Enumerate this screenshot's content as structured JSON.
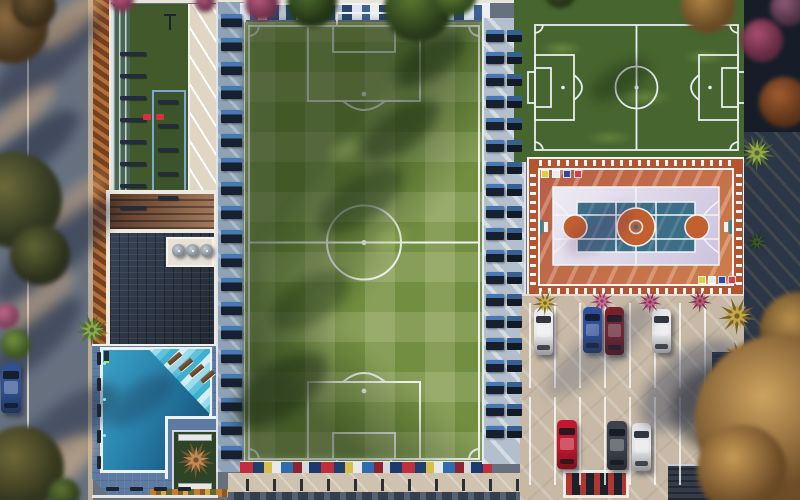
{
  "scene": {
    "description": "Aerial drone view render of a sports club complex: main soccer field, mini soccer field, multipurpose basketball and volleyball court, L-shaped swimming pool with clubhouse, outdoor gym strip, and parking lot with cars, surrounded by streets, palms and trees",
    "width": 800,
    "height": 500
  },
  "palette": {
    "street": "#66707f",
    "street_curb": "#b9ac98",
    "mulch": "#8a4e28",
    "turf_dark": "#42592c",
    "walkway_cream": "#e9e0cf",
    "roof_dark": "#2b3441",
    "roof_sun": "#7c513b",
    "trim_white": "#f1ede4",
    "deck_blue": "#5d7aa2",
    "water_light": "#3aa2c6",
    "water_deep": "#174f72",
    "steps_blue": "#9adceb",
    "grass_base": "#728e40",
    "field_line": "#eef2f4",
    "bench_navy": "#17202e",
    "bench_blue": "#4879b4",
    "strip_blue": "#8fa3b8",
    "stand_navy": "#2e4460",
    "court_ring_red": "#b5552f",
    "court_terracotta": "#c16a3a",
    "court_lavender": "#dcd7e8",
    "court_blue": "#3d6e88",
    "court_orange": "#c2602f",
    "parking_concrete": "#c7b9a5",
    "tree_gold": "#cda35f"
  },
  "strips": {
    "stand_main": {
      "angle": 90,
      "segments": [
        {
          "c": "#dfe7ee",
          "w": 10
        },
        {
          "c": "#3c6296",
          "w": 8
        },
        {
          "c": "#eceff3",
          "w": 9
        },
        {
          "c": "#27456e",
          "w": 12
        },
        {
          "c": "#b8c6d4",
          "w": 7
        },
        {
          "c": "#27456e",
          "w": 10
        }
      ]
    },
    "stand_mini": {
      "angle": 90,
      "segments": [
        {
          "c": "#d8e0e8",
          "w": 8
        },
        {
          "c": "#2e4f86",
          "w": 9
        },
        {
          "c": "#c44250",
          "w": 5
        },
        {
          "c": "#2e4f86",
          "w": 8
        },
        {
          "c": "#e8ebef",
          "w": 8
        },
        {
          "c": "#223c64",
          "w": 10
        }
      ]
    },
    "seats_south": {
      "angle": 90,
      "segments": [
        {
          "c": "#c22e3e",
          "w": 13
        },
        {
          "c": "#203e6e",
          "w": 11
        },
        {
          "c": "#d6c048",
          "w": 8
        },
        {
          "c": "#e9e9ec",
          "w": 9
        },
        {
          "c": "#2e6cb0",
          "w": 12
        },
        {
          "c": "#8c2432",
          "w": 9
        },
        {
          "c": "#d8d8da",
          "w": 7
        },
        {
          "c": "#1d3a6e",
          "w": 12
        }
      ]
    },
    "hedge_south": {
      "angle": 90,
      "segments": [
        {
          "c": "#c87c30",
          "w": 6
        },
        {
          "c": "#8a5a28",
          "w": 5
        },
        {
          "c": "#d8a848",
          "w": 5
        },
        {
          "c": "#5c6a30",
          "w": 6
        }
      ]
    }
  },
  "court": {
    "corner_colors": [
      "#e5cb3e",
      "#efece6",
      "#2e4a9e",
      "#d63c4a"
    ],
    "top_left": {
      "x": 541,
      "y": 170,
      "step": 11,
      "size": 8
    },
    "bottom_right": {
      "x": 698,
      "y": 276,
      "step": 10,
      "size": 8
    }
  },
  "cars": [
    {
      "name": "street-car-white",
      "x": 8,
      "y": 206,
      "w": 17,
      "h": 34,
      "color": "#e8e8ea"
    },
    {
      "name": "street-car-blue",
      "x": 1,
      "y": 363,
      "w": 20,
      "h": 50,
      "color": "#31508f"
    },
    {
      "name": "parked-white-1",
      "x": 534,
      "y": 308,
      "w": 19,
      "h": 47,
      "color": "#ececee"
    },
    {
      "name": "parked-blue",
      "x": 583,
      "y": 307,
      "w": 19,
      "h": 46,
      "color": "#2e4f9e"
    },
    {
      "name": "parked-dark-red",
      "x": 605,
      "y": 307,
      "w": 19,
      "h": 48,
      "color": "#7e1c28"
    },
    {
      "name": "parked-white-2",
      "x": 652,
      "y": 309,
      "w": 19,
      "h": 44,
      "color": "#e9e9ec"
    },
    {
      "name": "parked-red",
      "x": 557,
      "y": 420,
      "w": 20,
      "h": 49,
      "color": "#c0182e"
    },
    {
      "name": "parked-gray",
      "x": 607,
      "y": 421,
      "w": 20,
      "h": 49,
      "color": "#3c424c"
    },
    {
      "name": "parked-white-3",
      "x": 632,
      "y": 423,
      "w": 19,
      "h": 48,
      "color": "#e6e7e9"
    }
  ],
  "trees": [
    {
      "x": 12,
      "y": 28,
      "r": 36,
      "c1": "#8a6a40",
      "c2": "#46351e"
    },
    {
      "x": 34,
      "y": 6,
      "r": 22,
      "c1": "#6a5432",
      "c2": "#3a2d18"
    },
    {
      "x": 14,
      "y": 200,
      "r": 48,
      "c1": "#6a6a3a",
      "c2": "#2f3520"
    },
    {
      "x": 40,
      "y": 255,
      "r": 30,
      "c1": "#5f6434",
      "c2": "#2b301c"
    },
    {
      "x": 6,
      "y": 316,
      "r": 13,
      "c1": "#c06a8c",
      "c2": "#7c3e58"
    },
    {
      "x": 16,
      "y": 344,
      "r": 15,
      "c1": "#74923e",
      "c2": "#3c5424"
    },
    {
      "x": 22,
      "y": 468,
      "r": 42,
      "c1": "#6e6838",
      "c2": "#33361e"
    },
    {
      "x": 64,
      "y": 494,
      "r": 16,
      "c1": "#5f7632",
      "c2": "#2e401c"
    },
    {
      "x": 122,
      "y": 0,
      "r": 12,
      "c1": "#c05a80",
      "c2": "#7a3450"
    },
    {
      "x": 205,
      "y": 2,
      "r": 10,
      "c1": "#b05878",
      "c2": "#6e3048"
    },
    {
      "x": 262,
      "y": 4,
      "r": 17,
      "c1": "#b55a7c",
      "c2": "#6e3048"
    },
    {
      "x": 312,
      "y": 2,
      "r": 25,
      "c1": "#4e6c2e",
      "c2": "#223414"
    },
    {
      "x": 418,
      "y": 8,
      "r": 34,
      "c1": "#5a782f",
      "c2": "#27391a"
    },
    {
      "x": 455,
      "y": -6,
      "r": 22,
      "c1": "#74903c",
      "c2": "#324a1e"
    },
    {
      "x": 560,
      "y": -8,
      "r": 16,
      "c1": "#4a682c",
      "c2": "#223014"
    },
    {
      "x": 708,
      "y": 6,
      "r": 27,
      "c1": "#b08446",
      "c2": "#684a24"
    },
    {
      "x": 762,
      "y": 40,
      "r": 21,
      "c1": "#a84e6e",
      "c2": "#642a42"
    },
    {
      "x": 788,
      "y": 8,
      "r": 18,
      "c1": "#8c5a78",
      "c2": "#4e3044"
    },
    {
      "x": 784,
      "y": 102,
      "r": 25,
      "c1": "#a05c30",
      "c2": "#5c3318"
    },
    {
      "x": 798,
      "y": 330,
      "r": 38,
      "c1": "#b8904e",
      "c2": "#604322"
    },
    {
      "x": 780,
      "y": 420,
      "r": 85,
      "c1": "#cda35f",
      "c2": "#6e4d28"
    },
    {
      "x": 742,
      "y": 470,
      "r": 45,
      "c1": "#c79a55",
      "c2": "#6a4926"
    }
  ],
  "palms": [
    {
      "name": "palm-pool-west",
      "x": 92,
      "y": 330,
      "r": 17,
      "c1": "#8aa84c",
      "c2": "#50702c"
    },
    {
      "name": "palm-planter",
      "x": 196,
      "y": 460,
      "r": 19,
      "c1": "#c08a52",
      "c2": "#7c5630"
    },
    {
      "name": "palm-yellow",
      "x": 545,
      "y": 303,
      "r": 13,
      "c1": "#c8b050",
      "c2": "#7c6c2e"
    },
    {
      "name": "palm-pink-1",
      "x": 602,
      "y": 301,
      "r": 12,
      "c1": "#cf6d95",
      "c2": "#8c3f60"
    },
    {
      "name": "palm-pink-2",
      "x": 650,
      "y": 302,
      "r": 12,
      "c1": "#c86088",
      "c2": "#83395a"
    },
    {
      "name": "palm-pink-3",
      "x": 700,
      "y": 301,
      "r": 12,
      "c1": "#c05878",
      "c2": "#7a3450"
    },
    {
      "name": "palm-gold-big",
      "x": 737,
      "y": 316,
      "r": 19,
      "c1": "#c6a748",
      "c2": "#776428"
    },
    {
      "name": "palm-orange",
      "x": 739,
      "y": 356,
      "r": 15,
      "c1": "#c07a42",
      "c2": "#7a4a26"
    },
    {
      "name": "palm-east-green",
      "x": 757,
      "y": 153,
      "r": 19,
      "c1": "#94aa4a",
      "c2": "#52682a"
    },
    {
      "name": "palm-east-dark",
      "x": 757,
      "y": 242,
      "r": 11,
      "c1": "#3e5a2c",
      "c2": "#243818"
    }
  ],
  "shadows": [
    {
      "layer": "ground",
      "x": 45,
      "y": 60,
      "rx": 70,
      "ry": 22,
      "rot": -40,
      "c": "rgba(28,36,58,0.45)"
    },
    {
      "layer": "ground",
      "x": 30,
      "y": 150,
      "rx": 60,
      "ry": 20,
      "rot": -38,
      "c": "rgba(28,36,58,0.5)"
    },
    {
      "layer": "ground",
      "x": 55,
      "y": 250,
      "rx": 75,
      "ry": 24,
      "rot": -40,
      "c": "rgba(28,36,58,0.45)"
    },
    {
      "layer": "ground",
      "x": 35,
      "y": 340,
      "rx": 60,
      "ry": 20,
      "rot": -42,
      "c": "rgba(28,36,58,0.45)"
    },
    {
      "layer": "ground",
      "x": 60,
      "y": 430,
      "rx": 70,
      "ry": 22,
      "rot": -38,
      "c": "rgba(28,36,58,0.4)"
    },
    {
      "layer": "ground",
      "x": 70,
      "y": 20,
      "rx": 40,
      "ry": 14,
      "rot": -40,
      "c": "rgba(222,178,128,0.5)"
    },
    {
      "layer": "ground",
      "x": 20,
      "y": 115,
      "rx": 45,
      "ry": 14,
      "rot": -40,
      "c": "rgba(222,178,128,0.45)"
    },
    {
      "layer": "ground",
      "x": 75,
      "y": 200,
      "rx": 40,
      "ry": 12,
      "rot": -40,
      "c": "rgba(222,178,128,0.4)"
    },
    {
      "layer": "ground",
      "x": 40,
      "y": 300,
      "rx": 45,
      "ry": 14,
      "rot": -40,
      "c": "rgba(222,178,128,0.4)"
    },
    {
      "layer": "ground",
      "x": 50,
      "y": 470,
      "rx": 55,
      "ry": 20,
      "rot": -35,
      "c": "rgba(230,190,140,0.55)"
    },
    {
      "layer": "ground",
      "x": 140,
      "y": 400,
      "rx": 40,
      "ry": 16,
      "rot": -35,
      "c": "rgba(20,30,50,0.28)"
    },
    {
      "layer": "over",
      "x": 430,
      "y": 60,
      "rx": 40,
      "ry": 18,
      "rot": -35,
      "c": "rgba(20,38,14,0.5)"
    },
    {
      "layer": "over",
      "x": 400,
      "y": 130,
      "rx": 45,
      "ry": 20,
      "rot": -35,
      "c": "rgba(20,38,14,0.45)"
    },
    {
      "layer": "over",
      "x": 360,
      "y": 200,
      "rx": 50,
      "ry": 22,
      "rot": -35,
      "c": "rgba(20,38,14,0.4)"
    },
    {
      "layer": "over",
      "x": 310,
      "y": 300,
      "rx": 45,
      "ry": 22,
      "rot": -32,
      "c": "rgba(20,38,14,0.35)"
    },
    {
      "layer": "over",
      "x": 280,
      "y": 390,
      "rx": 55,
      "ry": 26,
      "rot": -35,
      "c": "rgba(18,34,12,0.45)"
    },
    {
      "layer": "over",
      "x": 345,
      "y": 150,
      "rx": 16,
      "ry": 8,
      "rot": -30,
      "c": "rgba(195,220,120,0.3)"
    },
    {
      "layer": "over",
      "x": 390,
      "y": 240,
      "rx": 18,
      "ry": 8,
      "rot": -30,
      "c": "rgba(195,220,120,0.28)"
    },
    {
      "layer": "over",
      "x": 620,
      "y": 80,
      "rx": 34,
      "ry": 14,
      "rot": -30,
      "c": "rgba(16,30,10,0.35)"
    },
    {
      "layer": "over",
      "x": 600,
      "y": 230,
      "rx": 40,
      "ry": 16,
      "rot": -32,
      "c": "rgba(90,40,90,0.22)"
    },
    {
      "layer": "over",
      "x": 600,
      "y": 350,
      "rx": 70,
      "ry": 20,
      "rot": -40,
      "c": "rgba(60,70,100,0.25)"
    },
    {
      "layer": "over",
      "x": 690,
      "y": 385,
      "rx": 60,
      "ry": 32,
      "rot": -40,
      "c": "rgba(45,55,85,0.4)"
    },
    {
      "layer": "over",
      "x": 726,
      "y": 408,
      "rx": 55,
      "ry": 45,
      "rot": 0,
      "c": "rgba(28,34,48,0.5)"
    }
  ],
  "furniture": [
    {
      "kind": "bar",
      "axis": "y",
      "x": 120,
      "from": 52,
      "to": 208,
      "step": 22,
      "w": 26,
      "h": 4
    },
    {
      "kind": "bar",
      "axis": "y",
      "x": 158,
      "from": 100,
      "to": 196,
      "step": 24,
      "w": 20,
      "h": 4
    },
    {
      "kind": "bench",
      "axis": "y",
      "x": 97,
      "from": 352,
      "to": 470,
      "step": 26,
      "w": 4,
      "h": 13
    },
    {
      "kind": "bench",
      "axis": "x",
      "y": 487,
      "from": 106,
      "to": 196,
      "step": 24,
      "w": 13,
      "h": 4
    },
    {
      "kind": "mat",
      "axis": "y",
      "x": 221,
      "from": 14,
      "to": 452,
      "step": 24,
      "w": 21,
      "h": 13
    },
    {
      "kind": "mat",
      "axis": "y",
      "x": 486,
      "from": 30,
      "to": 446,
      "step": 22,
      "w": 18,
      "h": 12
    },
    {
      "kind": "mat2",
      "axis": "y",
      "x": 507,
      "from": 30,
      "to": 446,
      "step": 22,
      "w": 15,
      "h": 12
    },
    {
      "kind": "post",
      "axis": "x",
      "y": 479,
      "from": 246,
      "to": 516,
      "step": 27,
      "w": 3,
      "h": 12
    },
    {
      "kind": "pline",
      "axis": "x",
      "y": 303,
      "from": 529,
      "to": 705,
      "step": 25,
      "w": 2,
      "h": 85
    },
    {
      "kind": "pline",
      "axis": "x",
      "y": 397,
      "from": 529,
      "to": 705,
      "step": 25,
      "w": 2,
      "h": 88
    }
  ],
  "gym_red_items": [
    {
      "x": 143,
      "y": 114
    },
    {
      "x": 156,
      "y": 114
    }
  ],
  "loungers": [
    {
      "x": 167,
      "y": 356
    },
    {
      "x": 178,
      "y": 362
    },
    {
      "x": 189,
      "y": 368
    },
    {
      "x": 200,
      "y": 374
    }
  ],
  "umbrellas": [
    {
      "x": 172,
      "y": 244,
      "d": 13
    },
    {
      "x": 186,
      "y": 244,
      "d": 13
    },
    {
      "x": 200,
      "y": 244,
      "d": 13
    }
  ],
  "pool_dots": [
    {
      "x": 103,
      "y": 362
    },
    {
      "x": 103,
      "y": 398
    },
    {
      "x": 103,
      "y": 434
    }
  ]
}
